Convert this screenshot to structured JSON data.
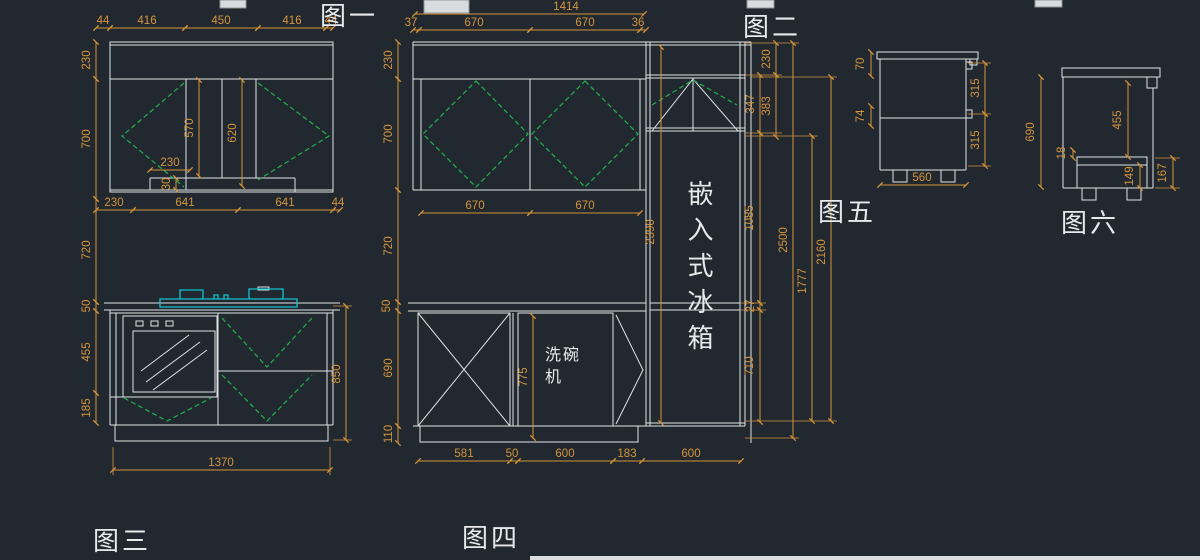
{
  "colors": {
    "background": "#212830",
    "line": "#dfe3e5",
    "dimension": "#d6953a",
    "door_swing": "#22b14c",
    "cooktop": "#17c1cf"
  },
  "labels": {
    "fig1": "图一",
    "fig2": "图二",
    "fig3": "图三",
    "fig4": "图四",
    "fig5": "图五",
    "fig6": "图六",
    "fridge": "嵌入式冰箱",
    "dishwasher": "洗碗机"
  },
  "left_elevation": {
    "top_chain": [
      "44",
      "416",
      "450",
      "416",
      "44"
    ],
    "height_chain": [
      "230",
      "700",
      "720",
      "50",
      "455",
      "185"
    ],
    "panel_heights": [
      "570",
      "620"
    ],
    "notch_width": "230",
    "notch_height": "30",
    "mid_chain": [
      "230",
      "641",
      "641",
      "44"
    ],
    "base_height": "850",
    "overall_width": "1370"
  },
  "middle_elevation": {
    "overall_width": "1414",
    "top_chain": [
      "37",
      "670",
      "670",
      "36"
    ],
    "height_chain": [
      "230",
      "700",
      "720",
      "50",
      "690",
      "110"
    ],
    "door_widths": [
      "670",
      "670"
    ],
    "fridge_column_height": "2390",
    "dishwasher_opening": "775",
    "bottom_chain": [
      "581",
      "50",
      "600",
      "183",
      "600"
    ],
    "right_chain_a": [
      "347",
      "1085",
      "27",
      "710"
    ],
    "right_chain_b": [
      "230",
      "383"
    ],
    "overall_height": "2500",
    "mid_height": "1777",
    "inner_height": "2160"
  },
  "side_view_5": {
    "top_gap": "70",
    "mid_gap": "74",
    "drawer_heights": [
      "315",
      "315"
    ],
    "depth": "560"
  },
  "side_view_6": {
    "height": "690",
    "opening": "455",
    "shelf_thickness": "18",
    "drawer_inner": "149",
    "drawer_total": "167"
  }
}
